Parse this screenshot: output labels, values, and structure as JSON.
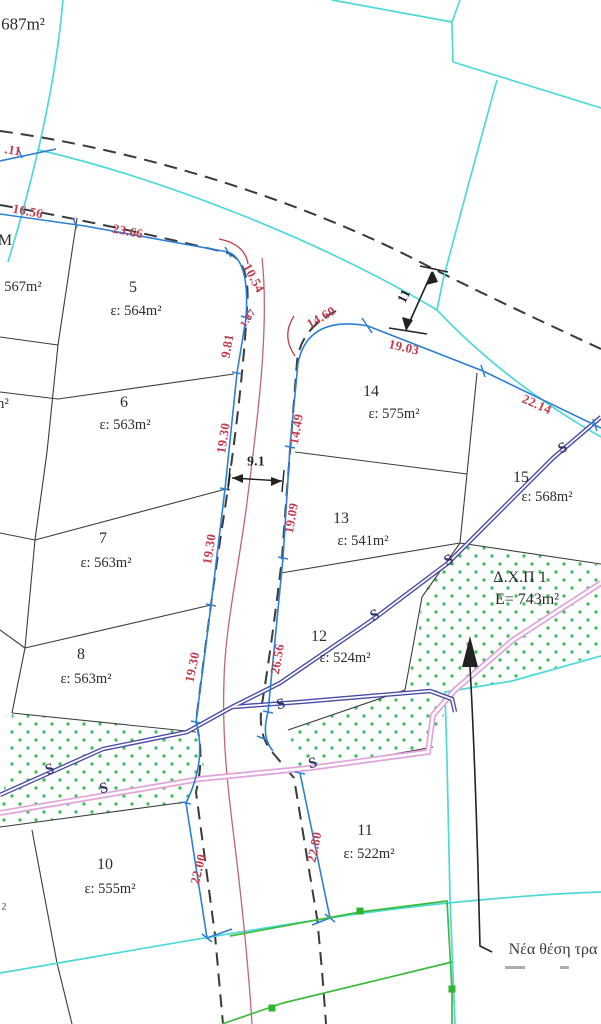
{
  "canvas": {
    "width": 601,
    "height": 1024,
    "background": "#ffffff"
  },
  "colors": {
    "parcel_line": "#3c3c3c",
    "road_dash": "#3a3a3a",
    "cadastral_cyan": "#4ed9d9",
    "frontage_blue": "#2d7fd3",
    "dimension_red": "#c23b4e",
    "road_center_red": "#c06575",
    "pipeline_navy": "#4a4aa8",
    "pipeline_pink": "#e2a2dc",
    "green_line": "#3dbb3d",
    "stipple_green": "#46bf63"
  },
  "parcels": [
    {
      "id": "5",
      "area": "ε: 564m²"
    },
    {
      "id": "6",
      "area": "ε: 563m²"
    },
    {
      "id": "7",
      "area": "ε: 563m²"
    },
    {
      "id": "8",
      "area": "ε: 563m²"
    },
    {
      "id": "10",
      "area": "ε: 555m²"
    },
    {
      "id": "11",
      "area": "ε: 522m²"
    },
    {
      "id": "12",
      "area": "ε: 524m²"
    },
    {
      "id": "13",
      "area": "ε: 541m²"
    },
    {
      "id": "14",
      "area": "ε: 575m²"
    },
    {
      "id": "15",
      "area": "ε: 568m²"
    },
    {
      "id": "Δ.Χ.Π 1",
      "area": "E= 743m²"
    }
  ],
  "edge_fragments": [
    "687m²",
    "567m²",
    "M",
    "m²",
    "2"
  ],
  "dimensions_red": [
    ".11",
    "16.56",
    "23.66",
    "10.54",
    "1.87",
    "9.81",
    "19.30",
    "19.30",
    "19.30",
    "14.60",
    "19.03",
    "22.14",
    "14.49",
    "19.09",
    "26.56",
    "22.00",
    "22.80"
  ],
  "dimensions_black": [
    "9.1",
    "11"
  ],
  "annotation": {
    "text": "Νέα θέση τρα"
  },
  "labels": [
    {
      "name": "dim-road-011",
      "text": ".11",
      "x": 13,
      "y": 150,
      "rot": 10,
      "cls": "dim"
    },
    {
      "name": "dim-1656",
      "text": "16.56",
      "x": 28,
      "y": 211,
      "rot": 11,
      "cls": "dim"
    },
    {
      "name": "dim-2366",
      "text": "23.66",
      "x": 128,
      "y": 231,
      "rot": 11,
      "cls": "dim"
    },
    {
      "name": "dim-1054",
      "text": "10.54",
      "x": 254,
      "y": 278,
      "rot": 62,
      "cls": "dim"
    },
    {
      "name": "dim-187",
      "text": "1.87",
      "x": 249,
      "y": 319,
      "rot": -56,
      "cls": "dim sm"
    },
    {
      "name": "dim-981",
      "text": "9.81",
      "x": 227,
      "y": 346,
      "rot": -80,
      "cls": "dim"
    },
    {
      "name": "dim-1930-a",
      "text": "19.30",
      "x": 223,
      "y": 438,
      "rot": -81,
      "cls": "dim"
    },
    {
      "name": "dim-1930-b",
      "text": "19.30",
      "x": 209,
      "y": 549,
      "rot": -81,
      "cls": "dim"
    },
    {
      "name": "dim-1930-c",
      "text": "19.30",
      "x": 192,
      "y": 667,
      "rot": -78,
      "cls": "dim"
    },
    {
      "name": "dim-1460",
      "text": "14.60",
      "x": 321,
      "y": 317,
      "rot": -30,
      "cls": "dim"
    },
    {
      "name": "dim-1903",
      "text": "19.03",
      "x": 404,
      "y": 347,
      "rot": 13,
      "cls": "dim"
    },
    {
      "name": "dim-2214",
      "text": "22.14",
      "x": 537,
      "y": 404,
      "rot": 24,
      "cls": "dim"
    },
    {
      "name": "dim-1449",
      "text": "14.49",
      "x": 296,
      "y": 429,
      "rot": -80,
      "cls": "dim"
    },
    {
      "name": "dim-1909",
      "text": "19.09",
      "x": 291,
      "y": 518,
      "rot": -80,
      "cls": "dim"
    },
    {
      "name": "dim-2656",
      "text": "26.56",
      "x": 277,
      "y": 659,
      "rot": -80,
      "cls": "dim"
    },
    {
      "name": "dim-2200",
      "text": "22.00",
      "x": 198,
      "y": 869,
      "rot": -76,
      "cls": "dim"
    },
    {
      "name": "dim-2280",
      "text": "22.80",
      "x": 314,
      "y": 847,
      "rot": -78,
      "cls": "dim"
    },
    {
      "name": "dim-road-width",
      "text": "9.1",
      "x": 256,
      "y": 461,
      "rot": 0,
      "cls": "dim dark"
    },
    {
      "name": "dim-11",
      "text": "11",
      "x": 404,
      "y": 296,
      "rot": -64,
      "cls": "dim dark"
    },
    {
      "name": "parcel-5-num",
      "text": "5",
      "x": 133,
      "y": 288,
      "rot": 0,
      "cls": "pnum"
    },
    {
      "name": "parcel-5-area",
      "text": "ε: 564m²",
      "x": 136,
      "y": 311,
      "rot": 0,
      "cls": "parea"
    },
    {
      "name": "parcel-6-num",
      "text": "6",
      "x": 124,
      "y": 403,
      "rot": 0,
      "cls": "pnum"
    },
    {
      "name": "parcel-6-area",
      "text": "ε: 563m²",
      "x": 125,
      "y": 425,
      "rot": 0,
      "cls": "parea"
    },
    {
      "name": "parcel-7-num",
      "text": "7",
      "x": 103,
      "y": 539,
      "rot": 0,
      "cls": "pnum"
    },
    {
      "name": "parcel-7-area",
      "text": "ε: 563m²",
      "x": 106,
      "y": 563,
      "rot": 0,
      "cls": "parea"
    },
    {
      "name": "parcel-8-num",
      "text": "8",
      "x": 81,
      "y": 655,
      "rot": 0,
      "cls": "pnum"
    },
    {
      "name": "parcel-8-area",
      "text": "ε: 563m²",
      "x": 86,
      "y": 679,
      "rot": 0,
      "cls": "parea"
    },
    {
      "name": "parcel-10-num",
      "text": "10",
      "x": 105,
      "y": 865,
      "rot": 0,
      "cls": "pnum"
    },
    {
      "name": "parcel-10-area",
      "text": "ε: 555m²",
      "x": 110,
      "y": 889,
      "rot": 0,
      "cls": "parea"
    },
    {
      "name": "parcel-11-num",
      "text": "11",
      "x": 365,
      "y": 831,
      "rot": 0,
      "cls": "pnum"
    },
    {
      "name": "parcel-11-area",
      "text": "ε: 522m²",
      "x": 369,
      "y": 854,
      "rot": 0,
      "cls": "parea"
    },
    {
      "name": "parcel-12-num",
      "text": "12",
      "x": 319,
      "y": 637,
      "rot": 0,
      "cls": "pnum"
    },
    {
      "name": "parcel-12-area",
      "text": "ε: 524m²",
      "x": 345,
      "y": 658,
      "rot": 0,
      "cls": "parea"
    },
    {
      "name": "parcel-13-num",
      "text": "13",
      "x": 341,
      "y": 519,
      "rot": 0,
      "cls": "pnum"
    },
    {
      "name": "parcel-13-area",
      "text": "ε: 541m²",
      "x": 363,
      "y": 541,
      "rot": 0,
      "cls": "parea"
    },
    {
      "name": "parcel-14-num",
      "text": "14",
      "x": 371,
      "y": 392,
      "rot": 0,
      "cls": "pnum"
    },
    {
      "name": "parcel-14-area",
      "text": "ε: 575m²",
      "x": 394,
      "y": 414,
      "rot": 0,
      "cls": "parea"
    },
    {
      "name": "parcel-15-num",
      "text": "15",
      "x": 521,
      "y": 478,
      "rot": 0,
      "cls": "pnum"
    },
    {
      "name": "parcel-15-area",
      "text": "ε: 568m²",
      "x": 547,
      "y": 497,
      "rot": 0,
      "cls": "parea"
    },
    {
      "name": "fragment-687",
      "text": "687m²",
      "x": 23,
      "y": 24,
      "rot": 0,
      "cls": "parea lg"
    },
    {
      "name": "fragment-567",
      "text": "567m²",
      "x": 23,
      "y": 287,
      "rot": 0,
      "cls": "parea"
    },
    {
      "name": "fragment-m",
      "text": "M",
      "x": 5,
      "y": 241,
      "rot": 0,
      "cls": "pnum"
    },
    {
      "name": "fragment-m2",
      "text": "m²",
      "x": 1,
      "y": 404,
      "rot": 0,
      "cls": "parea"
    },
    {
      "name": "fragment-2",
      "text": "2",
      "x": 4,
      "y": 907,
      "rot": 0,
      "cls": "parea xs"
    },
    {
      "name": "dxp-title",
      "text": "Δ.Χ.Π 1",
      "x": 520,
      "y": 578,
      "rot": 0,
      "cls": "dxp"
    },
    {
      "name": "dxp-area",
      "text": "E= 743m²",
      "x": 527,
      "y": 600,
      "rot": 0,
      "cls": "dxp"
    },
    {
      "name": "note-new-position",
      "text": "Νέα θέση τρα",
      "x": 553,
      "y": 950,
      "rot": 0,
      "cls": "note"
    },
    {
      "name": "pipeline-s-1",
      "text": "S",
      "x": 563,
      "y": 449,
      "rot": -25,
      "cls": "smark"
    },
    {
      "name": "pipeline-s-2",
      "text": "S",
      "x": 449,
      "y": 561,
      "rot": -25,
      "cls": "smark"
    },
    {
      "name": "pipeline-s-3",
      "text": "S",
      "x": 375,
      "y": 616,
      "rot": -25,
      "cls": "smark"
    },
    {
      "name": "pipeline-s-4",
      "text": "S",
      "x": 281,
      "y": 705,
      "rot": -15,
      "cls": "smark"
    },
    {
      "name": "pipeline-s-5",
      "text": "S",
      "x": 50,
      "y": 770,
      "rot": -20,
      "cls": "smark"
    },
    {
      "name": "pipeline-s-6",
      "text": "S",
      "x": 104,
      "y": 789,
      "rot": -15,
      "cls": "smark"
    },
    {
      "name": "pipeline-s-7",
      "text": "S",
      "x": 313,
      "y": 764,
      "rot": -15,
      "cls": "smark"
    }
  ]
}
